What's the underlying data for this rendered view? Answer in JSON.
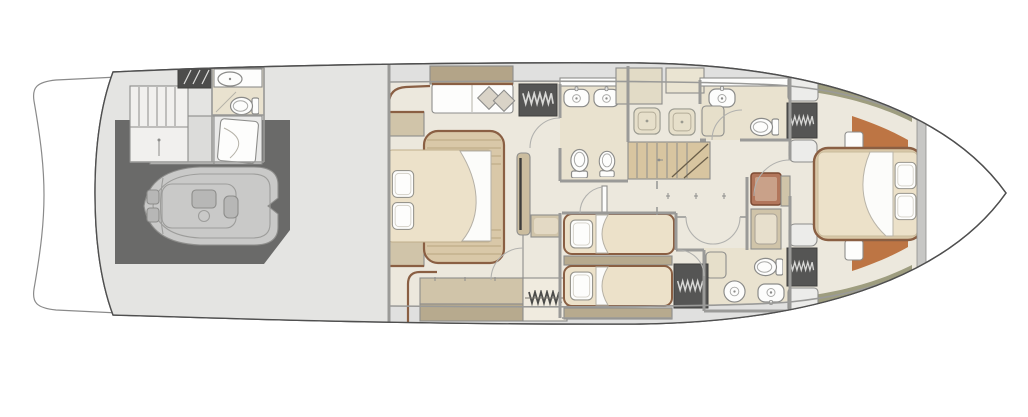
{
  "colors": {
    "background": "#ffffff",
    "hull_fill": "#ffffff",
    "hull_line": "#4f4f4f",
    "deck": "#e4e4e2",
    "band": "#e0e0df",
    "wall": "#9a9a98",
    "floor": "#ece8dd",
    "bath_floor": "#e9e2cf",
    "tan": "#b3a488",
    "cabinet": "#d0c4a9",
    "cabinet_dark": "#b7aa8e",
    "cabinet_light": "#ececea",
    "bed_frame": "#d9c8a8",
    "mattress": "#ece1c9",
    "trim_brown": "#8a5f43",
    "garage": "#6a6a69",
    "wardrobe": "#555554",
    "hatch_dark": "#4c4c4b",
    "terracotta": "#bd7544",
    "khaki": "#9e9d7f",
    "stairs": "#d8c5a0",
    "tender": "#c9c9c8",
    "tender_detail": "#b7b7b6",
    "seat_brown": "#b2765b",
    "seat_inner": "#c9a189",
    "fixture_white": "#ffffff",
    "bulkhead": "#c7c7c5",
    "cushion": "#d9d3c7",
    "shelf_beige": "#e2dbc6",
    "shelf_beige_light": "#eae4d2",
    "tv_panel": "#cbbd9f",
    "crew_room_gray": "#dcdcda",
    "crew_bed_bg": "#e9e9e8"
  },
  "floorplan": {
    "type": "yacht-deck-plan",
    "deck": "lower-deck",
    "orientation": "bow-right",
    "zones": [
      {
        "name": "swim-platform",
        "items": [
          "platform"
        ]
      },
      {
        "name": "aft-deck-garage",
        "items": [
          "tender-rib",
          "crew-stairs",
          "companionway-hatch",
          "crew-head-sink",
          "crew-head-toilet",
          "crew-berth"
        ]
      },
      {
        "name": "master-cabin",
        "items": [
          "sofa",
          "scatter-pillows",
          "hanging-locker",
          "double-bed",
          "tv-partition",
          "side-cabinet",
          "nightstands",
          "sideboard",
          "wardrobe"
        ]
      },
      {
        "name": "master-bathroom",
        "items": [
          "twin-sinks",
          "toilet",
          "bidet",
          "shower",
          "shower"
        ]
      },
      {
        "name": "midship-lobby",
        "items": [
          "staircase",
          "double-doors",
          "seat",
          "vanity-desk",
          "passage-door"
        ]
      },
      {
        "name": "guest-bathroom-forward-top",
        "items": [
          "sink",
          "toilet",
          "shower"
        ]
      },
      {
        "name": "guest-bathroom-forward-bottom",
        "items": [
          "sink",
          "toilet",
          "washer",
          "shower"
        ]
      },
      {
        "name": "twin-guest-cabin",
        "items": [
          "single-bed",
          "single-bed",
          "mid-shelf",
          "hanging-locker"
        ]
      },
      {
        "name": "vip-cabin",
        "items": [
          "double-bed",
          "pillows",
          "hanging-lockers",
          "side-cabinets",
          "terracotta-floor-panels",
          "side-lockers"
        ]
      },
      {
        "name": "bow-locker",
        "items": []
      }
    ]
  }
}
